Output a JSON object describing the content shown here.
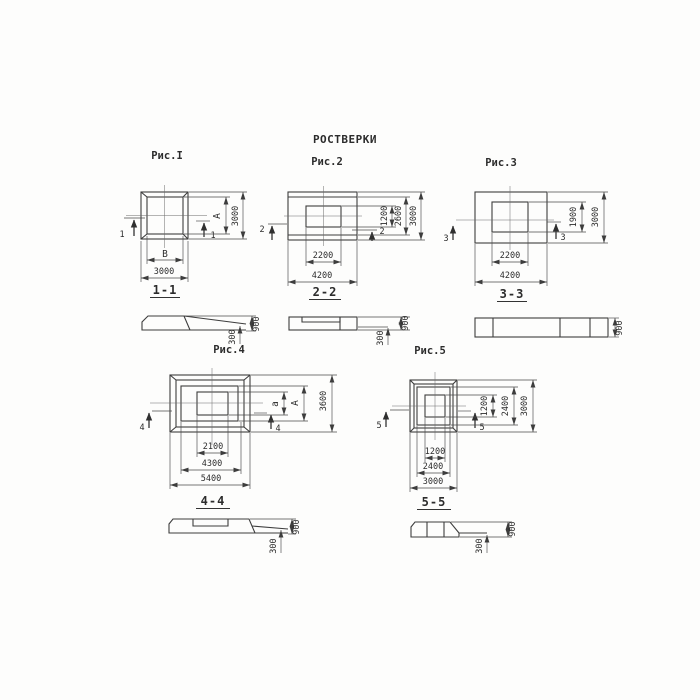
{
  "title": "РОСТВЕРКИ",
  "fig1": {
    "label": "Рис.I",
    "section": "1-1",
    "cut": "1",
    "inner_width": "В",
    "outer_width": "3000",
    "inner_height": "А",
    "outer_height": "3000"
  },
  "sec1": {
    "edge_height": "300",
    "total_height": "900"
  },
  "fig2": {
    "label": "Рис.2",
    "section": "2-2",
    "cut": "2",
    "inner_width": "2200",
    "outer_width": "4200",
    "inner_height": "1200",
    "mid_height": "2600",
    "outer_height": "3000"
  },
  "sec2": {
    "edge_height": "300",
    "total_height": "900"
  },
  "fig3": {
    "label": "Рис.3",
    "section": "3-3",
    "cut": "3",
    "inner_width": "2200",
    "outer_width": "4200",
    "inner_height": "1900",
    "outer_height": "3000"
  },
  "sec3": {
    "total_height": "900"
  },
  "fig4": {
    "label": "Рис.4",
    "section": "4-4",
    "cut": "4",
    "inner_width": "2100",
    "mid_width": "4300",
    "outer_width": "5400",
    "inner_height": "а",
    "mid_height": "А",
    "outer_height": "3600"
  },
  "sec4": {
    "edge_height": "300",
    "total_height": "900"
  },
  "fig5": {
    "label": "Рис.5",
    "section": "5-5",
    "cut": "5",
    "inner_width": "1200",
    "mid_width": "2400",
    "outer_width": "3000",
    "inner_height": "1200",
    "mid_height": "2400",
    "outer_height": "3000"
  },
  "sec5": {
    "edge_height": "300",
    "total_height": "900"
  }
}
